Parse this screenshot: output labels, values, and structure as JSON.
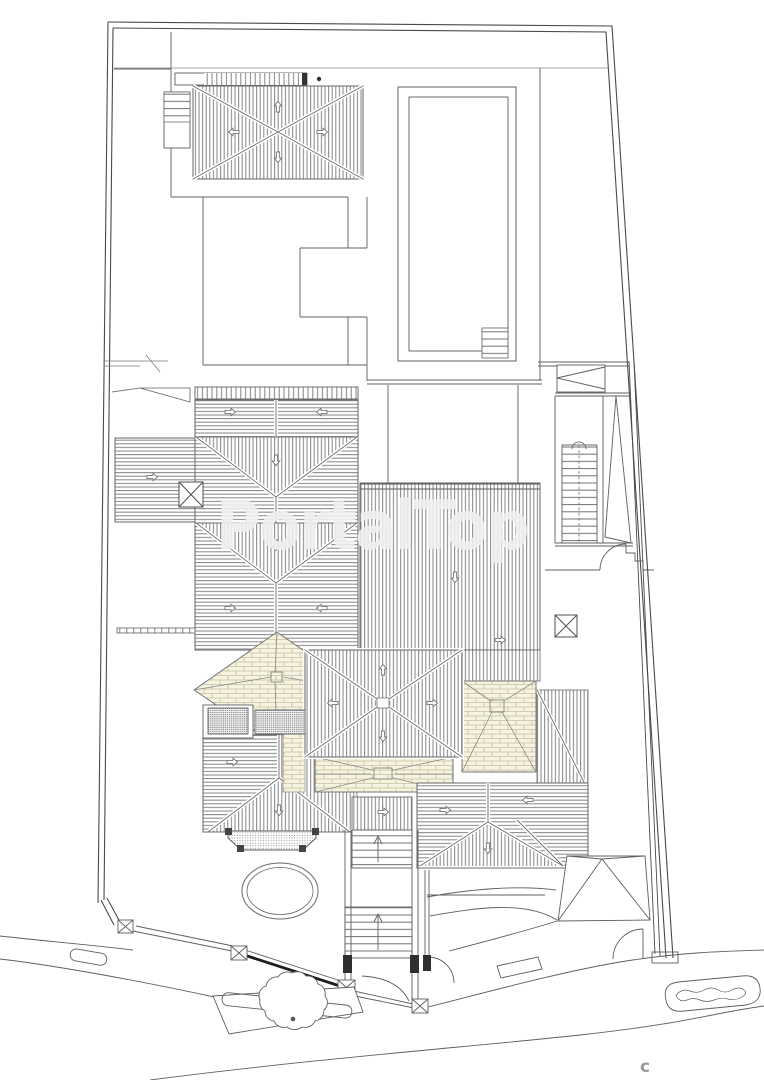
{
  "watermark": {
    "text": "PortalTop"
  },
  "footer": {
    "copyright_text": "c"
  },
  "colors": {
    "background": "#ffffff",
    "line": "#5f5f5f",
    "line_dark": "#2f2f2f",
    "hatch_line": "#8f8f8f",
    "brick_fill": "#f6f3e1",
    "brick_line": "#c6bfa0",
    "stipple": "#8d8d8d",
    "watermark_text": "#f0f0f0",
    "copyright_text": "#9a9a9a"
  }
}
